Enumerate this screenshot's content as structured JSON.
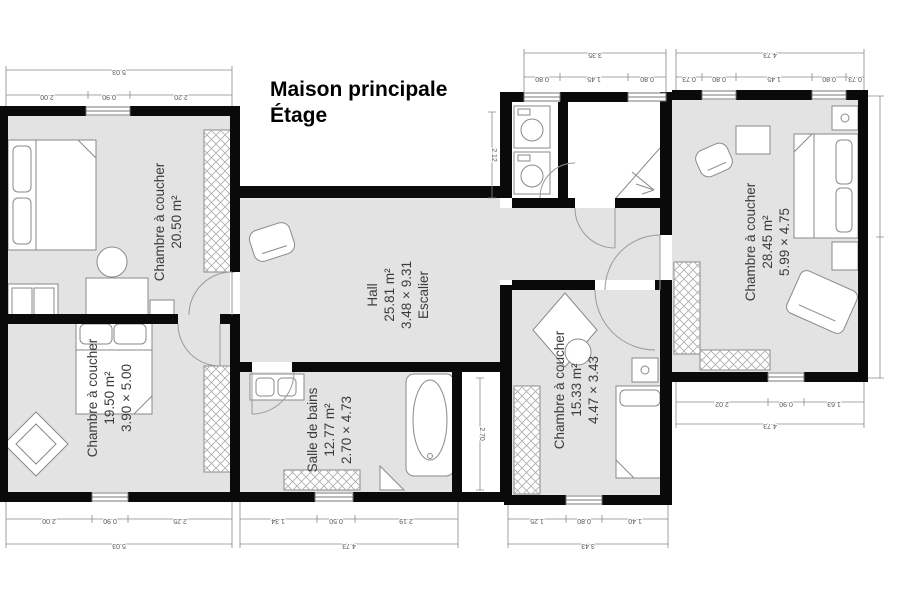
{
  "title": {
    "line1": "Maison principale",
    "line2": "Étage"
  },
  "rooms": {
    "bedroom_top_left": {
      "name": "Chambre à coucher",
      "area": "20.50 m²"
    },
    "bedroom_bottom_left": {
      "name": "Chambre à coucher",
      "area": "19.50 m²",
      "dims": "3.90 × 5.00"
    },
    "hall": {
      "name": "Hall",
      "area": "25.81 m²",
      "dims": "3.48 × 9.31",
      "stair": "Escalier"
    },
    "bathroom": {
      "name": "Salle de bains",
      "area": "12.77 m²",
      "dims": "2.70 × 4.73"
    },
    "bedroom_center": {
      "name": "Chambre à coucher",
      "area": "15.33 m²",
      "dims": "4.47 × 3.43"
    },
    "bedroom_right": {
      "name": "Chambre à coucher",
      "area": "28.45 m²",
      "dims": "5.99 × 4.75"
    }
  },
  "dims": {
    "top_left": {
      "total": "5.03",
      "segments": [
        "2.00",
        "0.90",
        "2.20"
      ]
    },
    "top_mid": {
      "total": "3.35",
      "segments": [
        "0.80",
        "1.45",
        "0.80"
      ]
    },
    "top_right": {
      "total": "4.73",
      "segments": [
        "0.73",
        "0.80",
        "1.45",
        "0.80",
        "0.73"
      ]
    },
    "bottom_left": {
      "total": "5.03",
      "segments": [
        "2.00",
        "0.90",
        "2.25"
      ]
    },
    "bottom_mid": {
      "total": "4.73",
      "segments": [
        "1.34",
        "0.50",
        "2.19"
      ]
    },
    "bottom_center": {
      "total": "3.43",
      "segments": [
        "1.25",
        "0.80",
        "1.40"
      ]
    },
    "right_bottom": {
      "total": "4.73",
      "segments": [
        "2.02",
        "0.90",
        "1.63"
      ]
    },
    "vertical_hall": "2.12",
    "vertical_stairs": "2.70"
  },
  "colors": {
    "wall": "#0a0a0a",
    "room_fill": "#e3e3e3",
    "dimension": "#555555"
  }
}
